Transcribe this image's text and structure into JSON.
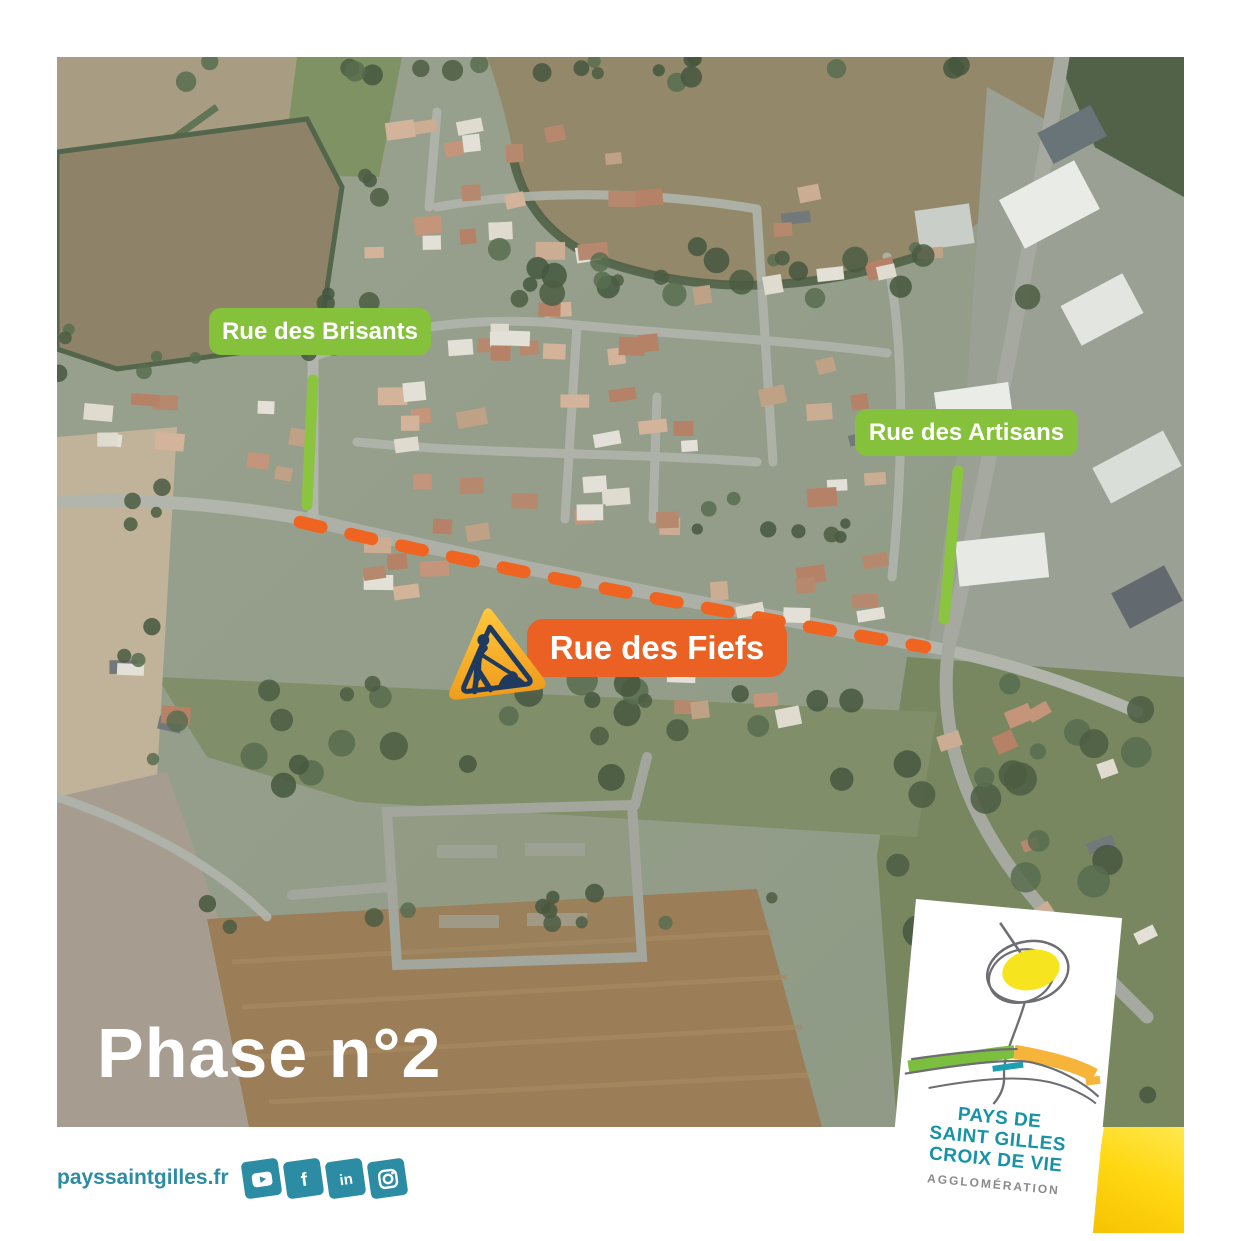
{
  "map": {
    "street_labels": {
      "brisants": "Rue des Brisants",
      "artisans": "Rue des Artisans",
      "fiefs": "Rue des Fiefs"
    },
    "phase_label": "Phase n°2"
  },
  "icons": {
    "roadworks": "roadworks-warning-triangle",
    "social": [
      "youtube-icon",
      "facebook-icon",
      "linkedin-icon",
      "instagram-icon"
    ],
    "social_glyphs": {
      "facebook": "f",
      "linkedin": "in"
    }
  },
  "footer": {
    "website": "payssaintgilles.fr"
  },
  "logo": {
    "line1": "PAYS DE",
    "line2": "SAINT GILLES",
    "line3": "CROIX DE VIE",
    "subtitle": "AGGLOMÉRATION"
  },
  "colors": {
    "green_label": "#85c13b",
    "highlight_green": "#8bc53f",
    "orange_label": "#ea6123",
    "dash_orange": "#ef6420",
    "teal": "#2b8ca4",
    "logo_teal": "#1793a8",
    "logo_grey": "#8a8a8a",
    "yellow_bar": "#ffd814",
    "triangle_navy": "#1e3a5f",
    "triangle_gold": "#f5a623"
  }
}
